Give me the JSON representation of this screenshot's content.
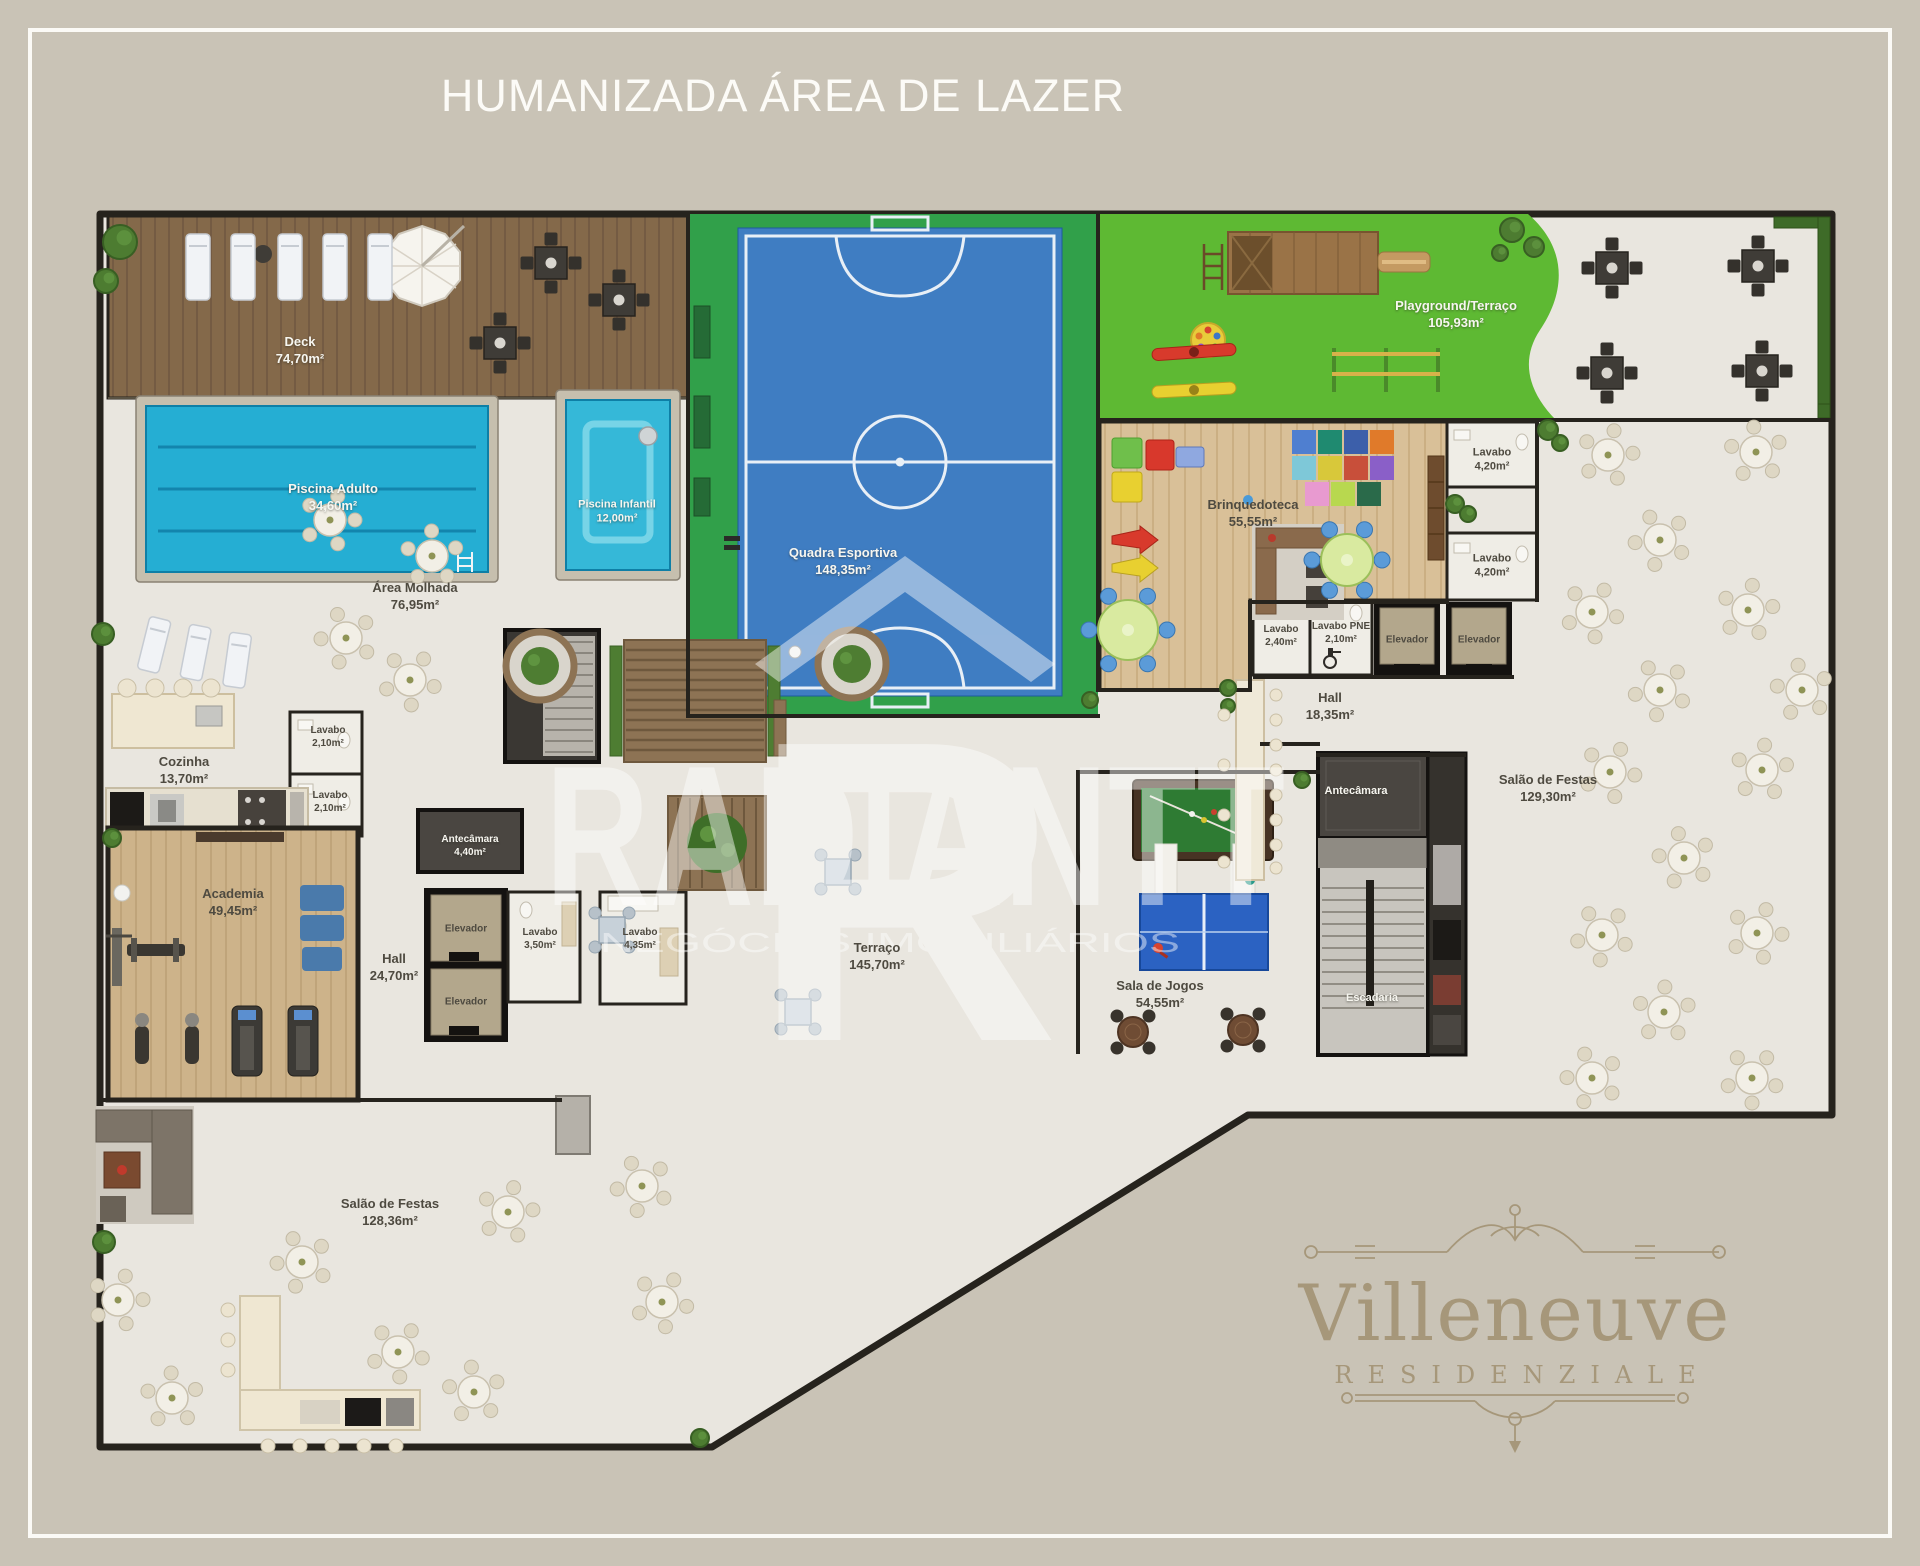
{
  "title": "HUMANIZADA ÁREA DE LAZER",
  "watermark": {
    "monogram": "R",
    "brand": "RADIANTT",
    "tagline": "NEGÓCIOS IMOBILIÁRIOS"
  },
  "logo": {
    "name": "Villeneuve",
    "subtitle": "RESIDENZIALE"
  },
  "colors": {
    "background": "#c9c3b6",
    "frame_white": "#fbfaf6",
    "wall": "#26231d",
    "floor": "#e9e6df",
    "deck_wood": "#84694a",
    "pool_water": "#25aed3",
    "court_green": "#31a04a",
    "court_blue": "#3f7dc2",
    "playground_grass": "#5eb933",
    "toyroom_wood": "#d9c098",
    "gym_wood": "#cdb38a",
    "logo_gold": "#a6977a"
  },
  "rooms": [
    {
      "id": "deck",
      "label": "Deck",
      "area": "74,70m²"
    },
    {
      "id": "piscina-adulto",
      "label": "Piscina Adulto",
      "area": "34,60m²"
    },
    {
      "id": "piscina-infantil",
      "label": "Piscina Infantil",
      "area": "12,00m²"
    },
    {
      "id": "area-molhada",
      "label": "Área Molhada",
      "area": "76,95m²"
    },
    {
      "id": "quadra-esportiva",
      "label": "Quadra Esportiva",
      "area": "148,35m²"
    },
    {
      "id": "playground-terraco",
      "label": "Playground/Terraço",
      "area": "105,93m²"
    },
    {
      "id": "brinquedoteca",
      "label": "Brinquedoteca",
      "area": "55,55m²"
    },
    {
      "id": "lavabo-1",
      "label": "Lavabo",
      "area": "4,20m²"
    },
    {
      "id": "lavabo-2",
      "label": "Lavabo",
      "area": "4,20m²"
    },
    {
      "id": "lavabo-3",
      "label": "Lavabo",
      "area": "2,40m²"
    },
    {
      "id": "lavabo-pne",
      "label": "Lavabo PNE",
      "area": "2,10m²"
    },
    {
      "id": "elevador-1",
      "label": "Elevador"
    },
    {
      "id": "elevador-2",
      "label": "Elevador"
    },
    {
      "id": "hall-direita",
      "label": "Hall",
      "area": "18,35m²"
    },
    {
      "id": "antecamara-direita",
      "label": "Antecâmara"
    },
    {
      "id": "salao-festas-direita",
      "label": "Salão de Festas",
      "area": "129,30m²"
    },
    {
      "id": "cozinha",
      "label": "Cozinha",
      "area": "13,70m²"
    },
    {
      "id": "lavabo-4",
      "label": "Lavabo",
      "area": "2,10m²"
    },
    {
      "id": "lavabo-5",
      "label": "Lavabo",
      "area": "2,10m²"
    },
    {
      "id": "antecamara-esquerda",
      "label": "Antecâmara",
      "area": "4,40m²"
    },
    {
      "id": "elevador-3",
      "label": "Elevador"
    },
    {
      "id": "elevador-4",
      "label": "Elevador"
    },
    {
      "id": "lavabo-6",
      "label": "Lavabo",
      "area": "3,50m²"
    },
    {
      "id": "lavabo-7",
      "label": "Lavabo",
      "area": "4,35m²"
    },
    {
      "id": "academia",
      "label": "Academia",
      "area": "49,45m²"
    },
    {
      "id": "hall-esquerda",
      "label": "Hall",
      "area": "24,70m²"
    },
    {
      "id": "terraco",
      "label": "Terraço",
      "area": "145,70m²"
    },
    {
      "id": "sala-de-jogos",
      "label": "Sala de Jogos",
      "area": "54,55m²"
    },
    {
      "id": "escadaria",
      "label": "Escadaria"
    },
    {
      "id": "salao-festas-esquerda",
      "label": "Salão de Festas",
      "area": "128,36m²"
    }
  ]
}
